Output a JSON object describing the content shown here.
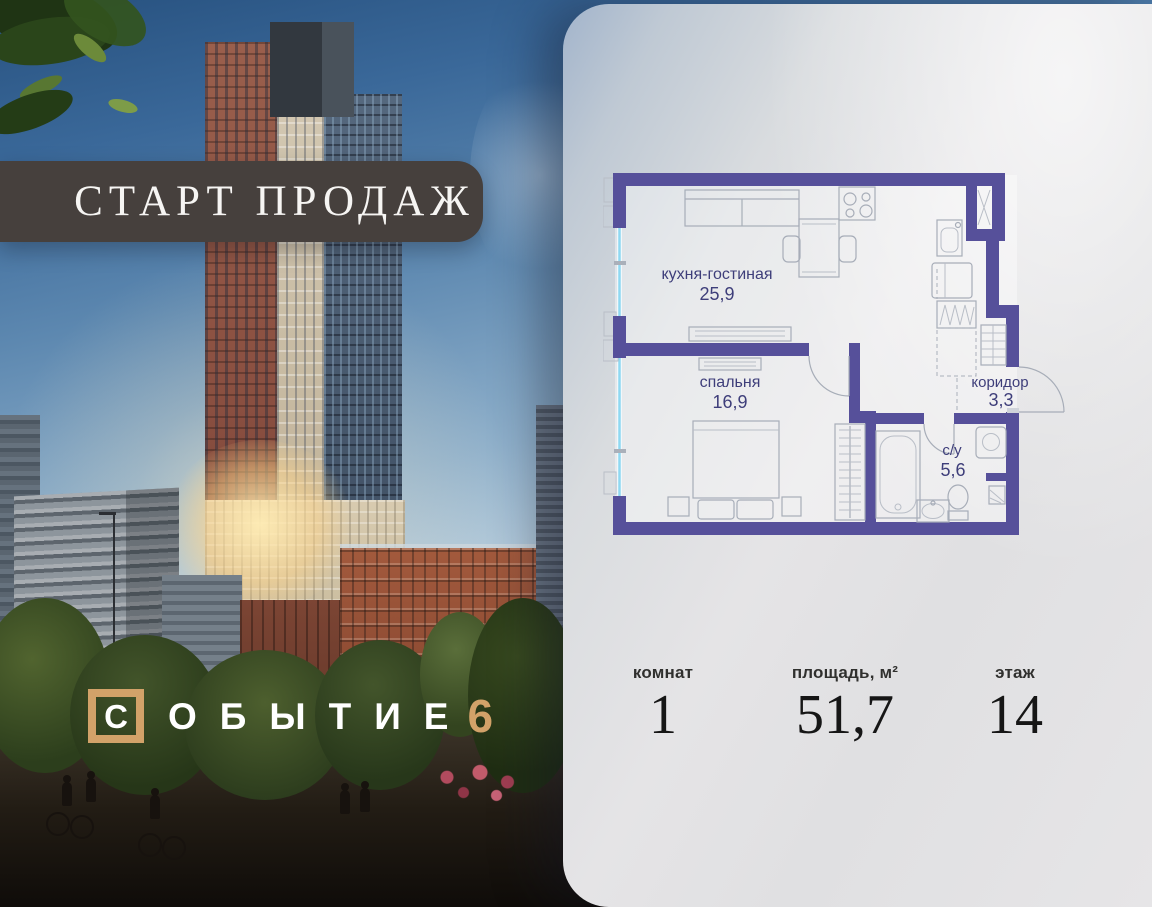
{
  "banner": {
    "text": "СТАРТ ПРОДАЖ"
  },
  "logo": {
    "boxed_letter": "С",
    "word_rest": "ОБЫТИЕ",
    "number": "6"
  },
  "floor_plan": {
    "rooms": [
      {
        "name": "кухня-гостиная",
        "area": "25,9"
      },
      {
        "name": "спальня",
        "area": "16,9"
      },
      {
        "name": "коридор",
        "area": "3,3"
      },
      {
        "name": "с/у",
        "area": "5,6"
      }
    ]
  },
  "stats": [
    {
      "label": "комнат",
      "value": "1"
    },
    {
      "label": "площадь, м²",
      "value": "51,7"
    },
    {
      "label": "этаж",
      "value": "14"
    }
  ],
  "colors": {
    "plan_wall": "#56509a",
    "plan_glass": "#8fd9f2",
    "gold": "#d2a269",
    "banner_bg": "#46403d",
    "label_ink": "#3e3e7a"
  }
}
